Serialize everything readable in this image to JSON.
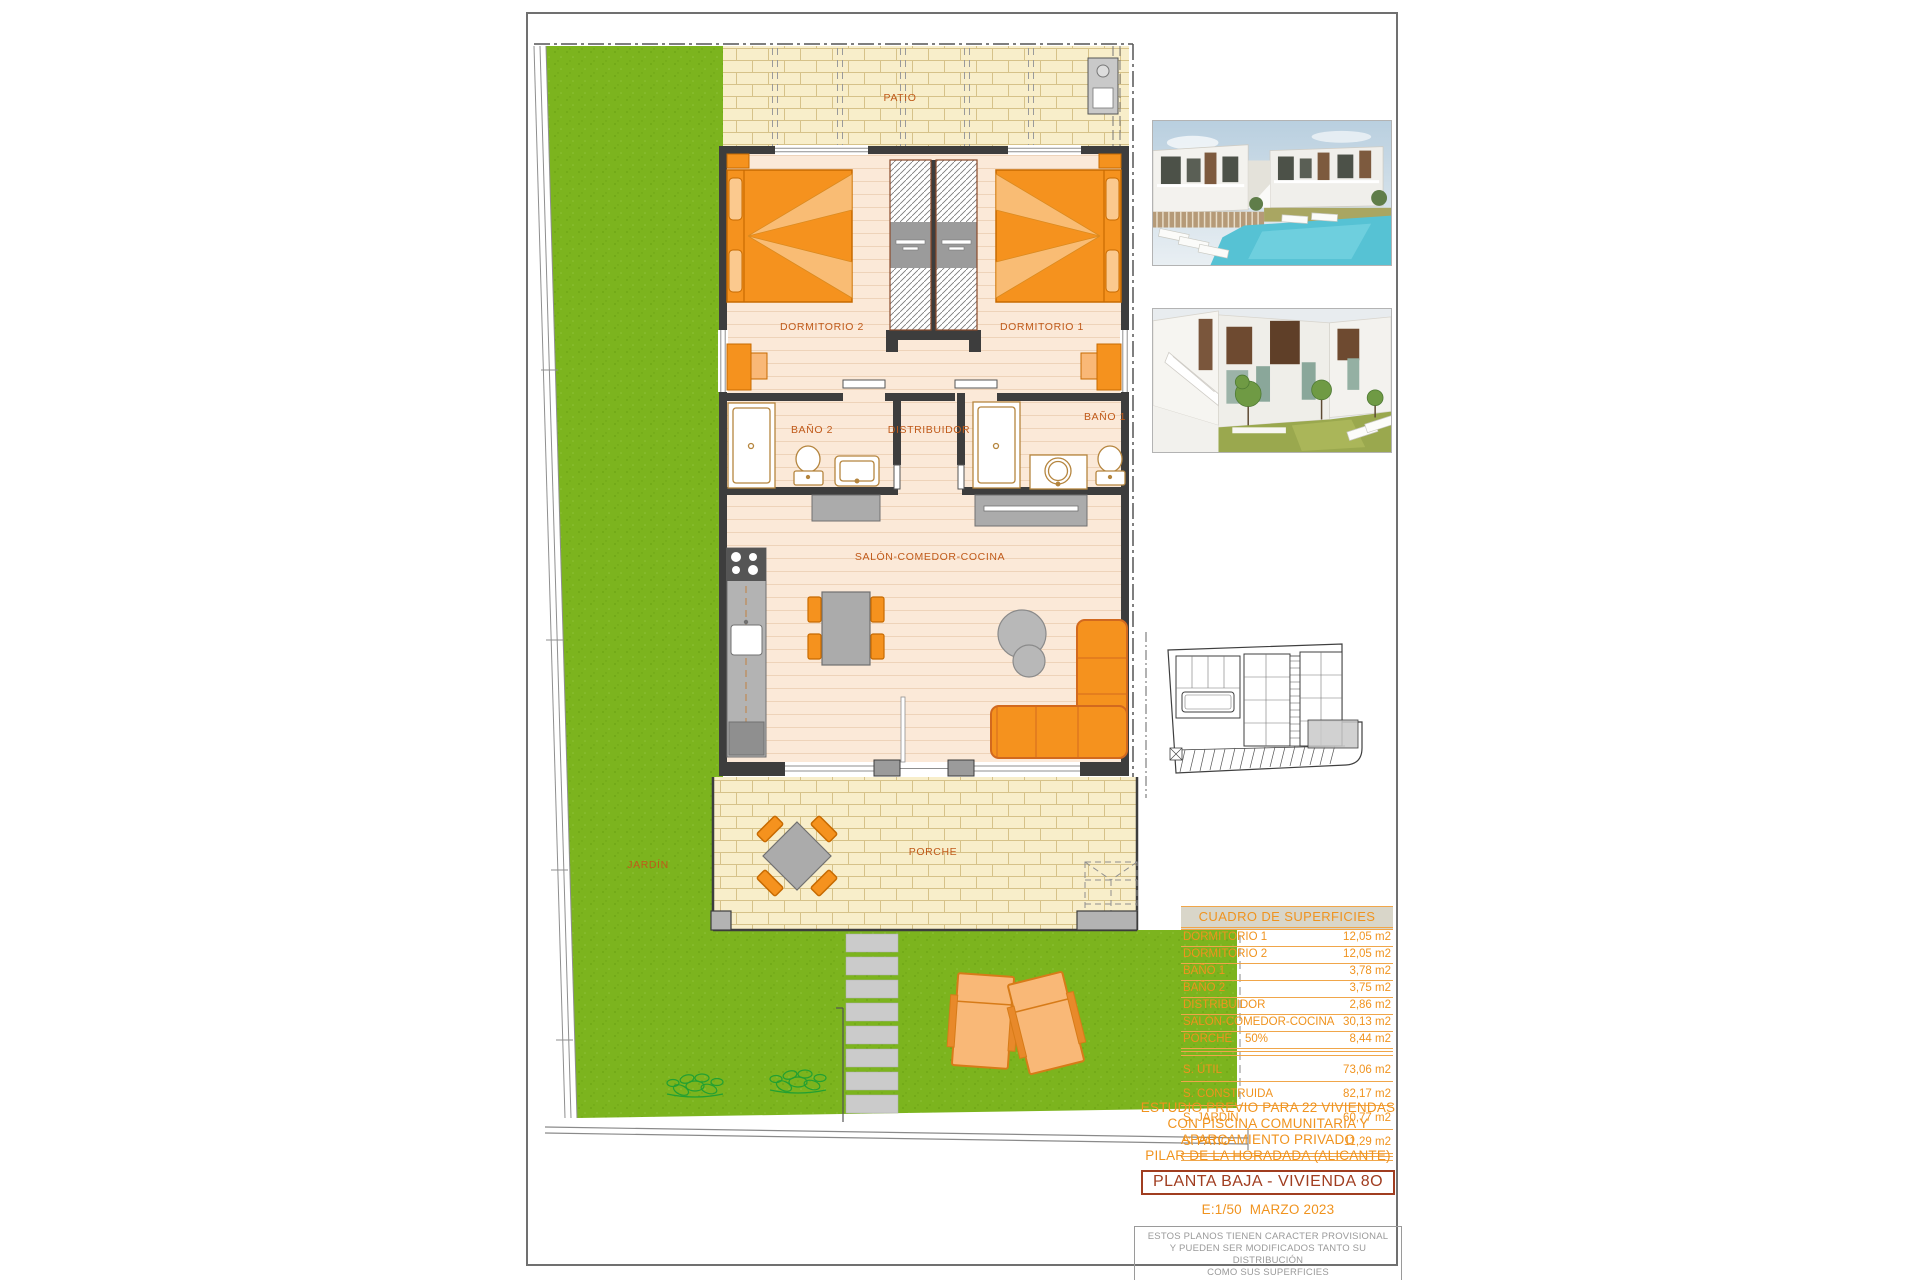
{
  "plan_labels": {
    "patio": "PATIO",
    "jardin": "JARDÍN",
    "porche": "PORCHE",
    "dormitorio2": "DORMITORIO 2",
    "dormitorio1": "DORMITORIO 1",
    "bano2": "BAÑO 2",
    "bano1": "BAÑO 1",
    "distribuidor": "DISTRIBUIDOR",
    "salon": "SALÓN-COMEDOR-COCINA"
  },
  "surfaces_table": {
    "title": "CUADRO DE SUPERFICIES",
    "rooms": [
      {
        "label": "DORMITORIO 1",
        "value": "12,05 m2"
      },
      {
        "label": "DORMITORIO 2",
        "value": "12,05 m2"
      },
      {
        "label": "BAÑO 1",
        "value": "3,78 m2"
      },
      {
        "label": "BAÑO 2",
        "value": "3,75 m2"
      },
      {
        "label": "DISTRIBUIDOR",
        "value": "2,86 m2"
      },
      {
        "label": "SALÓN-COMEDOR-COCINA",
        "value": "30,13 m2"
      },
      {
        "label": "PORCHE    50%",
        "value": "8,44 m2"
      }
    ],
    "totals": [
      {
        "label": "S. ÚTIL",
        "value": "73,06 m2"
      },
      {
        "label": "S. CONSTRUIDA",
        "value": "82,17 m2"
      },
      {
        "label": "S. JARDÍN",
        "value": "60,77 m2"
      },
      {
        "label": "S. PATIO",
        "value": "11,29 m2"
      }
    ]
  },
  "title_block": {
    "line1": "ESTUDIO PREVIO PARA 22 VIVIENDAS",
    "line2": "CON PISCINA COMUNITARIA Y",
    "line3": "APARCAMIENTO PRIVADO",
    "line4": "PILAR DE LA HORADADA (ALICANTE)",
    "plan_title": "PLANTA BAJA - VIVIENDA 8O",
    "scale_date": "E:1/50  MARZO 2023"
  },
  "disclaimer": {
    "line1": "ESTOS PLANOS TIENEN CARACTER PROVISIONAL",
    "line2": "Y PUEDEN SER MODIFICADOS TANTO SU DISTRIBUCIÓN",
    "line3": "COMO SUS SUPERFICIES"
  },
  "colors": {
    "grass": "#7cb41e",
    "brick": "#f8eeca",
    "floor": "#fbe9d8",
    "wall": "#3d3d3d",
    "furniture_orange": "#f5921e",
    "accent_text": "#f0931e",
    "room_label": "#c05a1a",
    "plan_title_red": "#a03d20"
  }
}
